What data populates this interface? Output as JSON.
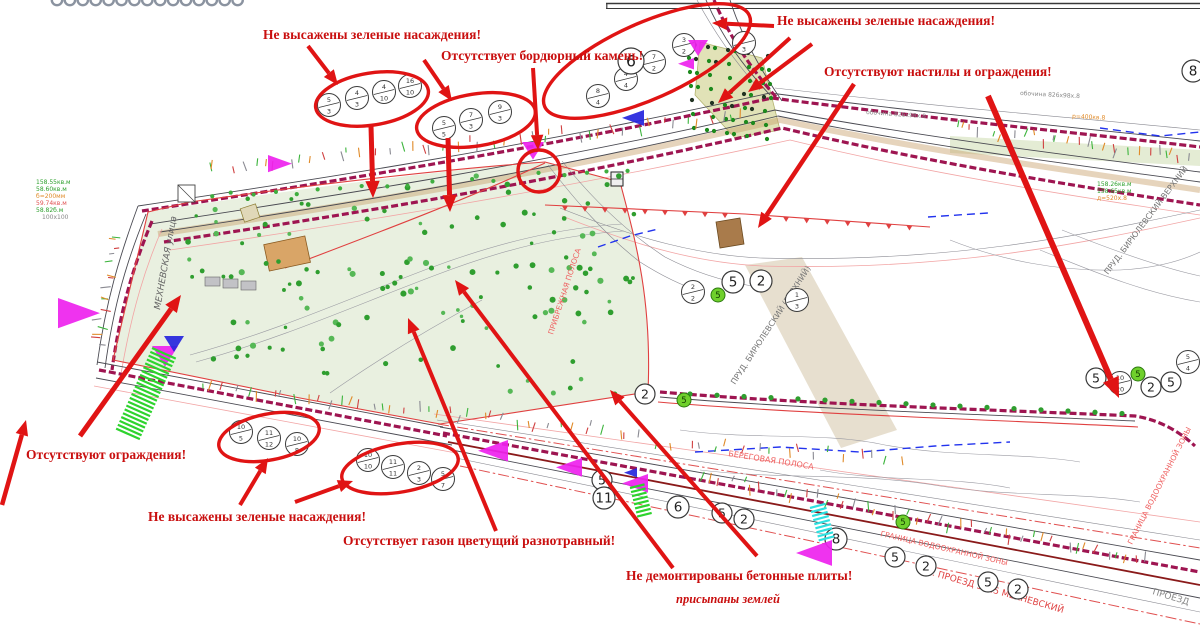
{
  "colors": {
    "annotation_red": "#e01414",
    "label_red": "#c90f0f",
    "crimson_road": "#9e1551",
    "tree_green": "#2f9e2f",
    "dense_green": "#1d8a1d",
    "map_green": "#2ea02e",
    "map_orange": "#e08a28",
    "map_red_text": "#ef6060",
    "magenta": "#ee22ee",
    "blue": "#2525dd",
    "green_hatch": "#2ed32e",
    "cyan_hatch": "#2ee0e0"
  },
  "defect_labels": [
    {
      "id": "label-green-1",
      "text": "Не высажены зеленые насаждения!",
      "x": 263,
      "y": 27,
      "italic": false
    },
    {
      "id": "label-curb",
      "text": "Отсутствует бордюрный камень!",
      "x": 441,
      "y": 48,
      "italic": false
    },
    {
      "id": "label-green-2",
      "text": "Не высажены зеленые насаждения!",
      "x": 777,
      "y": 13,
      "italic": false
    },
    {
      "id": "label-decks",
      "text": "Отсутствуют настилы и ограждения!",
      "x": 824,
      "y": 64,
      "italic": false
    },
    {
      "id": "label-fences",
      "text": "Отсутствуют ограждения!",
      "x": 26,
      "y": 447,
      "italic": false
    },
    {
      "id": "label-green-3",
      "text": "Не высажены зеленые насаждения!",
      "x": 148,
      "y": 509,
      "italic": false
    },
    {
      "id": "label-lawn",
      "text": "Отсутствует газон цветущий разнотравный!",
      "x": 343,
      "y": 533,
      "italic": false
    },
    {
      "id": "label-slabs",
      "text": "Не демонтированы бетонные плиты!",
      "x": 626,
      "y": 568,
      "italic": false
    },
    {
      "id": "label-slabs-note",
      "text": "присыпаны землей",
      "x": 676,
      "y": 592,
      "italic": true
    }
  ],
  "arrows": [
    {
      "x1": 308,
      "y1": 46,
      "x2": 338,
      "y2": 85,
      "w": 4
    },
    {
      "x1": 424,
      "y1": 60,
      "x2": 452,
      "y2": 101,
      "w": 4
    },
    {
      "x1": 533,
      "y1": 68,
      "x2": 538,
      "y2": 150,
      "w": 4
    },
    {
      "x1": 371,
      "y1": 126,
      "x2": 373,
      "y2": 198,
      "w": 5
    },
    {
      "x1": 448,
      "y1": 138,
      "x2": 450,
      "y2": 212,
      "w": 5
    },
    {
      "x1": 774,
      "y1": 26,
      "x2": 712,
      "y2": 23,
      "w": 4
    },
    {
      "x1": 790,
      "y1": 38,
      "x2": 718,
      "y2": 103,
      "w": 4
    },
    {
      "x1": 812,
      "y1": 44,
      "x2": 748,
      "y2": 92,
      "w": 4
    },
    {
      "x1": 854,
      "y1": 84,
      "x2": 758,
      "y2": 228,
      "w": 4.5
    },
    {
      "x1": 988,
      "y1": 96,
      "x2": 1119,
      "y2": 398,
      "w": 6
    },
    {
      "x1": 80,
      "y1": 436,
      "x2": 181,
      "y2": 295,
      "w": 5
    },
    {
      "x1": 2,
      "y1": 505,
      "x2": 26,
      "y2": 420,
      "w": 4.5
    },
    {
      "x1": 240,
      "y1": 505,
      "x2": 268,
      "y2": 458,
      "w": 4
    },
    {
      "x1": 295,
      "y1": 502,
      "x2": 353,
      "y2": 481,
      "w": 4
    },
    {
      "x1": 496,
      "y1": 531,
      "x2": 408,
      "y2": 318,
      "w": 4
    },
    {
      "x1": 673,
      "y1": 568,
      "x2": 455,
      "y2": 280,
      "w": 4
    },
    {
      "x1": 757,
      "y1": 556,
      "x2": 610,
      "y2": 390,
      "w": 4
    }
  ],
  "ellipses": [
    {
      "cx": 372,
      "cy": 99,
      "rx": 57,
      "ry": 26,
      "rot": -9
    },
    {
      "cx": 476,
      "cy": 120,
      "rx": 60,
      "ry": 26,
      "rot": -9
    },
    {
      "cx": 647,
      "cy": 61,
      "rx": 112,
      "ry": 38,
      "rot": -24
    },
    {
      "cx": 539,
      "cy": 171,
      "rx": 21,
      "ry": 21,
      "rot": 0
    },
    {
      "cx": 269,
      "cy": 437,
      "rx": 51,
      "ry": 23,
      "rot": -11
    },
    {
      "cx": 400,
      "cy": 468,
      "rx": 59,
      "ry": 24,
      "rot": -10
    }
  ],
  "tree_circles": [
    {
      "x": 329,
      "y": 105,
      "top": "5",
      "bot": "3"
    },
    {
      "x": 357,
      "y": 98,
      "top": "4",
      "bot": "3"
    },
    {
      "x": 384,
      "y": 92,
      "top": "4",
      "bot": "10"
    },
    {
      "x": 410,
      "y": 86,
      "top": "16",
      "bot": "10"
    },
    {
      "x": 444,
      "y": 128,
      "top": "5",
      "bot": "5"
    },
    {
      "x": 471,
      "y": 120,
      "top": "7",
      "bot": "3"
    },
    {
      "x": 500,
      "y": 112,
      "top": "9",
      "bot": "3"
    },
    {
      "x": 598,
      "y": 96,
      "top": "8",
      "bot": "4"
    },
    {
      "x": 626,
      "y": 79,
      "top": "4",
      "bot": "4"
    },
    {
      "x": 654,
      "y": 62,
      "top": "7",
      "bot": "2"
    },
    {
      "x": 684,
      "y": 45,
      "top": "3",
      "bot": "2"
    },
    {
      "x": 744,
      "y": 43,
      "top": "4",
      "bot": "3"
    },
    {
      "x": 241,
      "y": 432,
      "top": "10",
      "bot": "5"
    },
    {
      "x": 269,
      "y": 438,
      "top": "11",
      "bot": "12"
    },
    {
      "x": 297,
      "y": 444,
      "top": "10",
      "bot": "8"
    },
    {
      "x": 368,
      "y": 460,
      "top": "10",
      "bot": "10"
    },
    {
      "x": 393,
      "y": 467,
      "top": "11",
      "bot": "11"
    },
    {
      "x": 419,
      "y": 473,
      "top": "2",
      "bot": "3"
    },
    {
      "x": 443,
      "y": 479,
      "top": "5",
      "bot": "7"
    },
    {
      "x": 693,
      "y": 292,
      "top": "2",
      "bot": "2"
    },
    {
      "x": 797,
      "y": 300,
      "top": "1",
      "bot": "3"
    },
    {
      "x": 1120,
      "y": 383,
      "top": "10",
      "bot": "20"
    },
    {
      "x": 1188,
      "y": 362,
      "top": "5",
      "bot": "4"
    }
  ],
  "circled_numbers": [
    {
      "x": 631,
      "y": 61,
      "n": "6",
      "r": 13
    },
    {
      "x": 1193,
      "y": 71,
      "n": "8",
      "r": 11
    },
    {
      "x": 733,
      "y": 282,
      "n": "5",
      "r": 11
    },
    {
      "x": 761,
      "y": 281,
      "n": "2",
      "r": 11
    },
    {
      "x": 645,
      "y": 394,
      "n": "2",
      "r": 10
    },
    {
      "x": 602,
      "y": 480,
      "n": "5",
      "r": 10
    },
    {
      "x": 604,
      "y": 498,
      "n": "11",
      "r": 11
    },
    {
      "x": 678,
      "y": 507,
      "n": "6",
      "r": 11
    },
    {
      "x": 722,
      "y": 513,
      "n": "5",
      "r": 10
    },
    {
      "x": 744,
      "y": 519,
      "n": "2",
      "r": 10
    },
    {
      "x": 836,
      "y": 539,
      "n": "8",
      "r": 11
    },
    {
      "x": 895,
      "y": 557,
      "n": "5",
      "r": 10
    },
    {
      "x": 926,
      "y": 566,
      "n": "2",
      "r": 10
    },
    {
      "x": 988,
      "y": 582,
      "n": "5",
      "r": 10
    },
    {
      "x": 1018,
      "y": 589,
      "n": "2",
      "r": 10
    },
    {
      "x": 1096,
      "y": 378,
      "n": "5",
      "r": 10
    },
    {
      "x": 1151,
      "y": 387,
      "n": "2",
      "r": 10
    },
    {
      "x": 1171,
      "y": 382,
      "n": "5",
      "r": 10
    }
  ],
  "green_circled_numbers": [
    {
      "x": 718,
      "y": 295,
      "n": "5"
    },
    {
      "x": 684,
      "y": 400,
      "n": "5"
    },
    {
      "x": 1138,
      "y": 374,
      "n": "5"
    },
    {
      "x": 903,
      "y": 522,
      "n": "5"
    }
  ],
  "triangles": {
    "magenta": [
      {
        "x": 268,
        "y": 155,
        "s": 24,
        "d": "right"
      },
      {
        "x": 58,
        "y": 298,
        "s": 42,
        "d": "right"
      },
      {
        "x": 522,
        "y": 142,
        "s": 22,
        "d": "down"
      },
      {
        "x": 688,
        "y": 40,
        "s": 20,
        "d": "down"
      },
      {
        "x": 678,
        "y": 58,
        "s": 16,
        "d": "left"
      },
      {
        "x": 478,
        "y": 440,
        "s": 30,
        "d": "left"
      },
      {
        "x": 556,
        "y": 458,
        "s": 26,
        "d": "left"
      },
      {
        "x": 622,
        "y": 474,
        "s": 26,
        "d": "left"
      },
      {
        "x": 796,
        "y": 540,
        "s": 36,
        "d": "left"
      },
      {
        "x": 152,
        "y": 346,
        "s": 26,
        "d": "down"
      }
    ],
    "blue": [
      {
        "x": 622,
        "y": 110,
        "s": 22,
        "d": "left"
      },
      {
        "x": 164,
        "y": 336,
        "s": 20,
        "d": "down"
      },
      {
        "x": 624,
        "y": 468,
        "s": 13,
        "d": "left"
      }
    ]
  },
  "hatches": [
    {
      "x": 152,
      "y": 348,
      "w": 26,
      "h": 92,
      "rot": 24,
      "color": "#2ed32e"
    },
    {
      "x": 630,
      "y": 488,
      "w": 15,
      "h": 32,
      "rot": -14,
      "color": "#2ed32e"
    },
    {
      "x": 810,
      "y": 508,
      "w": 16,
      "h": 36,
      "rot": -15,
      "color": "#2ee0e0"
    }
  ],
  "map_texts": [
    {
      "t": "МЕХНЕВСКАЯ  улица",
      "x": 160,
      "y": 310,
      "rot": -80,
      "c": "#666666",
      "fs": 9,
      "i": true
    },
    {
      "t": "ПРУД. БИРЮЛЕВСКИЙ (ВЕРХНИЙ)",
      "x": 735,
      "y": 385,
      "rot": -57,
      "c": "#777777",
      "fs": 8,
      "i": false
    },
    {
      "t": "ПРУД. БИРЮЛЕВСКИЙ ВЕРХНИЙ",
      "x": 1108,
      "y": 275,
      "rot": -53,
      "c": "#777777",
      "fs": 8,
      "i": false
    },
    {
      "t": "ПР. ПРОЕЗД 5425 МЕХНЕВСКИЙ",
      "x": 920,
      "y": 572,
      "rot": 16,
      "c": "#e04545",
      "fs": 9,
      "i": false
    },
    {
      "t": "ПРОЕЗД",
      "x": 1152,
      "y": 594,
      "rot": 17,
      "c": "#888888",
      "fs": 9,
      "i": false
    },
    {
      "t": "БЕРЕГОВАЯ ПОЛОСА",
      "x": 728,
      "y": 456,
      "rot": 9,
      "c": "#ef6060",
      "fs": 8,
      "i": false
    },
    {
      "t": "ГРАНИЦА ВОДООХРАННОЙ ЗОНЫ",
      "x": 880,
      "y": 536,
      "rot": 13,
      "c": "#ef6060",
      "fs": 7.5,
      "i": false
    },
    {
      "t": "ГРАНИЦА ВОДООХРАННОЙ ЗОНЫ",
      "x": 1132,
      "y": 545,
      "rot": -63,
      "c": "#ef6060",
      "fs": 7.5,
      "i": false
    },
    {
      "t": "ПРИБРЕЖНАЯ ПОЛОСА",
      "x": 553,
      "y": 335,
      "rot": -72,
      "c": "#ef6060",
      "fs": 7.5,
      "i": false
    },
    {
      "t": "158.26кв.м",
      "x": 1097,
      "y": 186,
      "rot": 0,
      "c": "#2ea02e",
      "fs": 6,
      "i": false
    },
    {
      "t": "158.65кв.м",
      "x": 1097,
      "y": 193,
      "rot": 0,
      "c": "#2ea02e",
      "fs": 6,
      "i": false
    },
    {
      "t": "д=520х.8",
      "x": 1097,
      "y": 200,
      "rot": 0,
      "c": "#e08a28",
      "fs": 6,
      "i": false
    },
    {
      "t": "р=400кв.8",
      "x": 1072,
      "y": 118,
      "rot": 3,
      "c": "#e08a28",
      "fs": 6,
      "i": false
    },
    {
      "t": "обочина 826х98х.8",
      "x": 1020,
      "y": 95,
      "rot": 3,
      "c": "#888888",
      "fs": 6,
      "i": false
    },
    {
      "t": "обочина 826х98х.8",
      "x": 866,
      "y": 114,
      "rot": 4,
      "c": "#888888",
      "fs": 6,
      "i": false
    },
    {
      "t": "158.55кв.м",
      "x": 36,
      "y": 184,
      "rot": 0,
      "c": "#2ea02e",
      "fs": 6,
      "i": false
    },
    {
      "t": "58.60кв.м",
      "x": 36,
      "y": 191,
      "rot": 0,
      "c": "#2ea02e",
      "fs": 6,
      "i": false
    },
    {
      "t": "б=200мм",
      "x": 36,
      "y": 198,
      "rot": 0,
      "c": "#e08a28",
      "fs": 6,
      "i": false
    },
    {
      "t": "59.74кв.м",
      "x": 36,
      "y": 205,
      "rot": 0,
      "c": "#e05050",
      "fs": 6,
      "i": false
    },
    {
      "t": "58.82б.м",
      "x": 36,
      "y": 212,
      "rot": 0,
      "c": "#2ea02e",
      "fs": 6,
      "i": false
    },
    {
      "t": "100х100",
      "x": 42,
      "y": 219,
      "rot": 0,
      "c": "#888888",
      "fs": 6,
      "i": false
    }
  ],
  "scallops": {
    "count": 15,
    "start_x": 57,
    "spacing": 12.9
  }
}
